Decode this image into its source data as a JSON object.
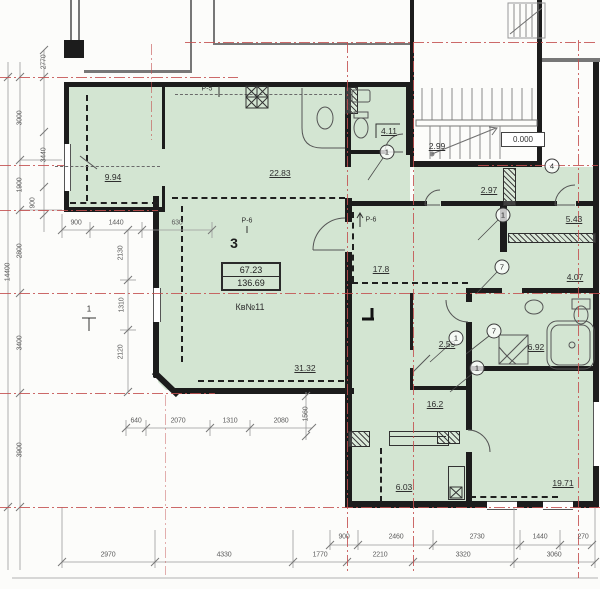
{
  "drawing": {
    "type_label": "apartment floor plan"
  },
  "apartment": {
    "room_number": "3",
    "area_upper": "67.23",
    "area_total": "136.69",
    "label": "Кв№11"
  },
  "rooms": {
    "r994": "9.94",
    "r2283": "22.83",
    "r411": "4.11",
    "r299": "2.99",
    "r297": "2.97",
    "r543": "5.43",
    "r407": "4.07",
    "r178": "17.8",
    "r3132": "31.32",
    "r259": "2.59",
    "r692": "6.92",
    "r162": "16.2",
    "r603": "6.03",
    "r1971": "19.71"
  },
  "elevation": "0.000",
  "labels": {
    "p5": "Р-5",
    "p6_left": "Р-6",
    "p6_right": "Р-6",
    "level_mark": "1"
  },
  "bubbles": {
    "b1": "1",
    "b2": "4",
    "b3": "1",
    "b4": "7",
    "b5": "7",
    "b6": "1",
    "b7": "1"
  },
  "dims": {
    "left": {
      "overall": "14400",
      "chain_a": [
        "3000",
        "1900",
        "2800",
        "3400",
        "3900"
      ],
      "chain_b": [
        "2770",
        "3440",
        "900"
      ]
    },
    "mid_top": [
      "900",
      "1440",
      "630"
    ],
    "mid_vert": [
      "2130",
      "1310",
      "2120"
    ],
    "mid_bottom": [
      "640",
      "2070",
      "1310",
      "2080"
    ],
    "mid_vert2": "1560",
    "bottom_upper": [
      "900",
      "2460",
      "2730",
      "1440",
      "270"
    ],
    "bottom_lower": [
      "2970",
      "4330",
      "1770",
      "2210",
      "3320",
      "3060"
    ]
  },
  "colors": {
    "floor_green": "#d3e5d2",
    "axis_red": "#c34f4f",
    "wall": "#1c1c1c"
  }
}
